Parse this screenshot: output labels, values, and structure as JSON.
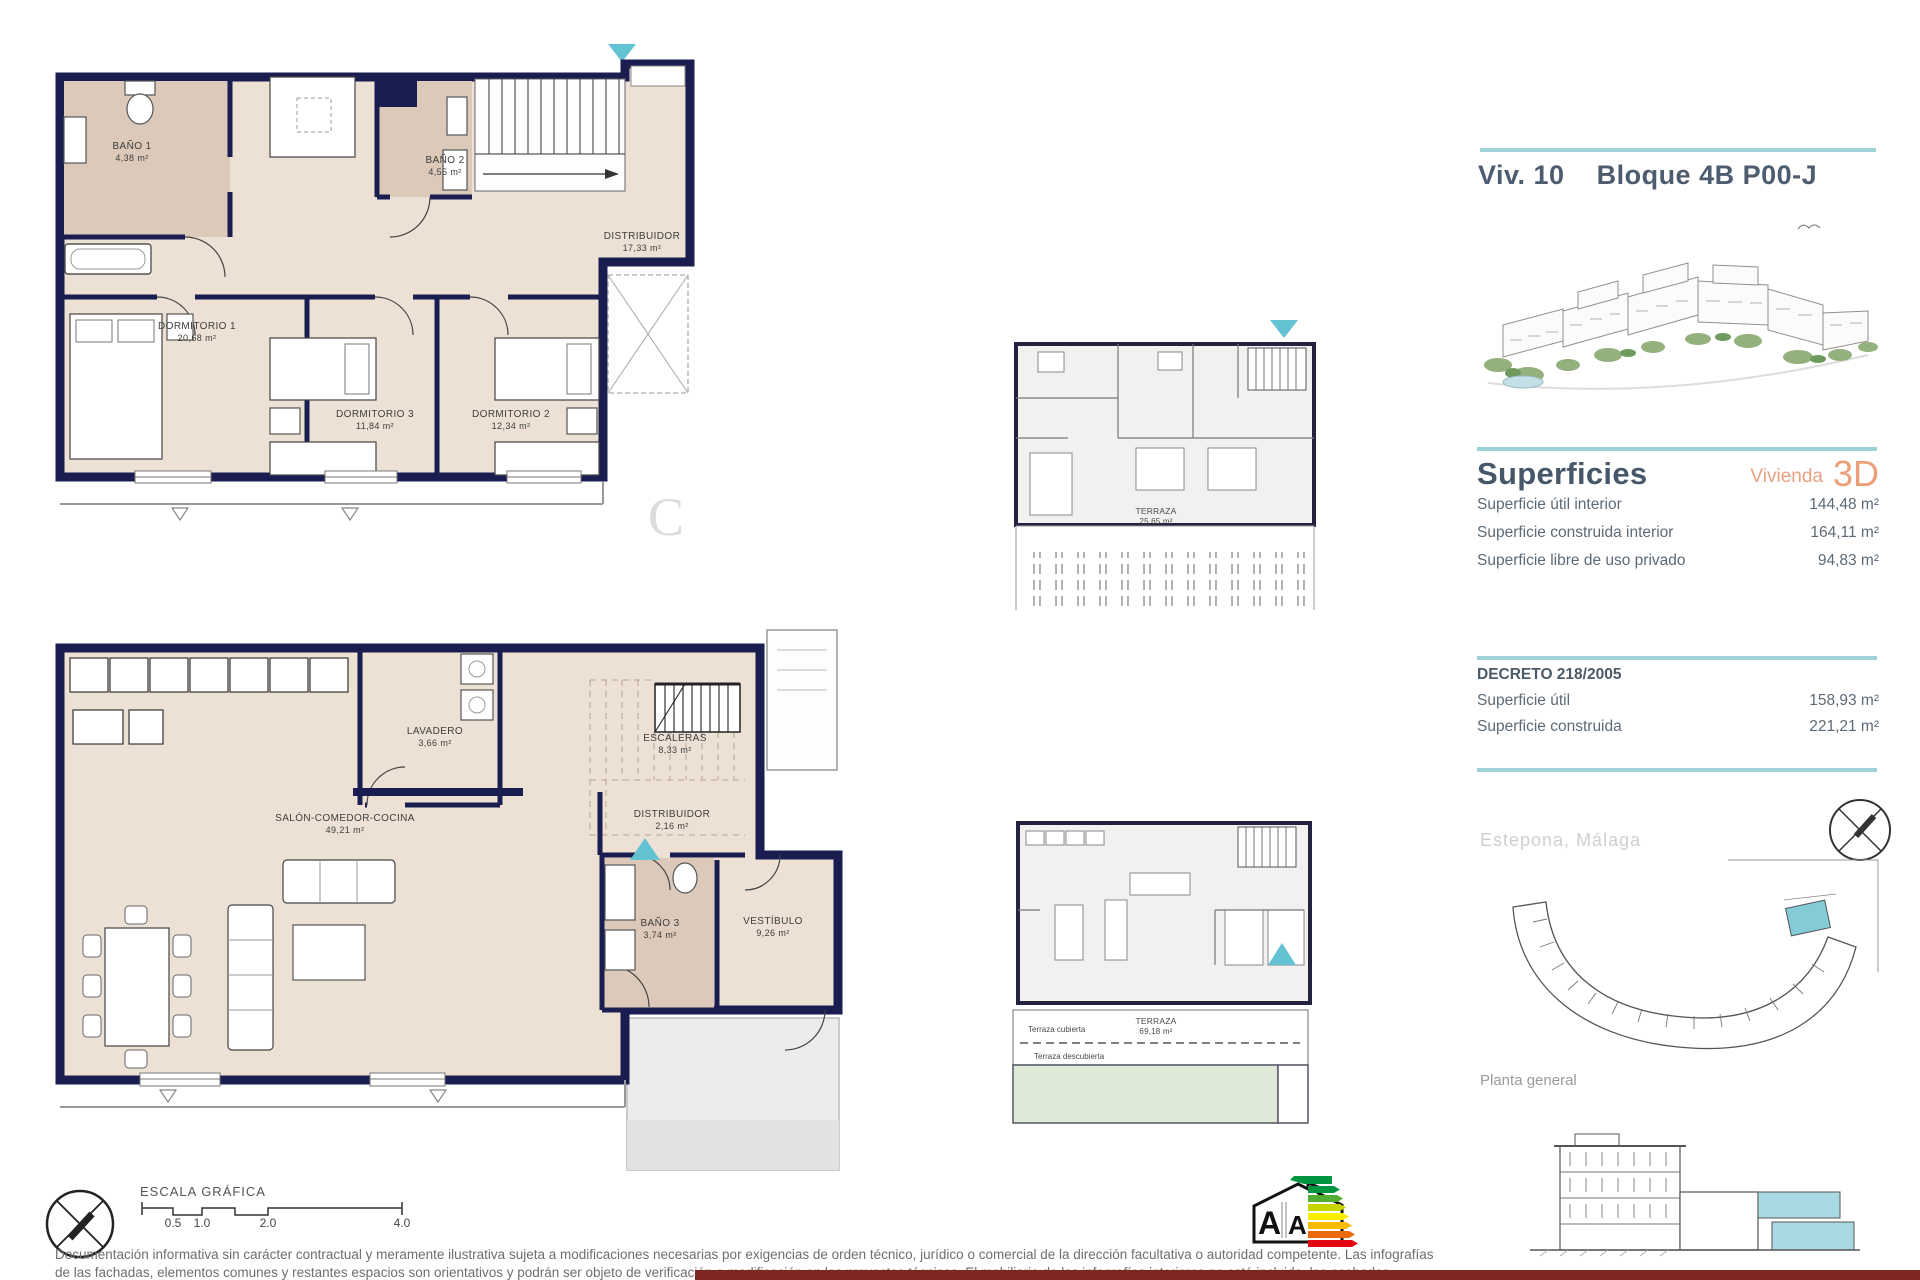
{
  "header": {
    "unit": "Viv. 10",
    "block": "Bloque 4B P00-J"
  },
  "watermark": "C",
  "upper_plan": {
    "rooms": [
      {
        "name": "BAÑO 1",
        "area": "4,38 m²"
      },
      {
        "name": "BAÑO 2",
        "area": "4,55 m²"
      },
      {
        "name": "DISTRIBUIDOR",
        "area": "17,33 m²"
      },
      {
        "name": "DORMITORIO 1",
        "area": "20,68 m²"
      },
      {
        "name": "DORMITORIO 3",
        "area": "11,84 m²"
      },
      {
        "name": "DORMITORIO 2",
        "area": "12,34 m²"
      }
    ]
  },
  "lower_plan": {
    "rooms": [
      {
        "name": "LAVADERO",
        "area": "3,66 m²"
      },
      {
        "name": "ESCALERAS",
        "area": "8,33 m²"
      },
      {
        "name": "SALÓN-COMEDOR-COCINA",
        "area": "49,21 m²"
      },
      {
        "name": "DISTRIBUIDOR",
        "area": "2,16 m²"
      },
      {
        "name": "BAÑO 3",
        "area": "3,74 m²"
      },
      {
        "name": "VESTÍBULO",
        "area": "9,26 m²"
      }
    ]
  },
  "thumb_upper": {
    "terrace": {
      "name": "TERRAZA",
      "area": "25,65 m²"
    }
  },
  "thumb_lower": {
    "terrace": {
      "name": "TERRAZA",
      "area": "69,18 m²"
    },
    "covered": "Terraza cubierta",
    "uncovered": "Terraza descubierta"
  },
  "superficies": {
    "title": "Superficies",
    "subtitle": "Vivienda",
    "badge": "3D",
    "rows": [
      {
        "label": "Superficie útil interior",
        "value": "144,48 m²"
      },
      {
        "label": "Superficie construida interior",
        "value": "164,11 m²"
      },
      {
        "label": "Superficie libre de uso privado",
        "value": "94,83 m²"
      }
    ]
  },
  "decreto": {
    "title": "DECRETO 218/2005",
    "rows": [
      {
        "label": "Superficie útil",
        "value": "158,93 m²"
      },
      {
        "label": "Superficie construida",
        "value": "221,21 m²"
      }
    ]
  },
  "location": {
    "city": "Estepona, Málaga",
    "plan_label": "Planta general"
  },
  "scale": {
    "title": "ESCALA GRÁFICA",
    "ticks": [
      "0.5",
      "1.0",
      "2.0",
      "4.0"
    ]
  },
  "energy": {
    "a_left": "A",
    "a_right": "A"
  },
  "footer": {
    "line1": "Documentación informativa sin carácter contractual y meramente ilustrativa sujeta a modificaciones necesarias por exigencias de orden técnico, jurídico o comercial de la dirección facultativa o autoridad competente. Las infografías",
    "line2": "de las fachadas, elementos comunes y restantes espacios son orientativos y podrán ser objeto de verificación o modificación en los proyectos técnicos. El mobiliario de las infografías interiores no está incluido, los acabados"
  },
  "colors": {
    "wall": "#191d4f",
    "floor": "#ece1d4",
    "wet_floor": "#dcc9b9",
    "teal_marker": "#63c3d3",
    "teal_line": "#9ed2d8",
    "accent_orange": "#e8a182",
    "maroon_bar": "#7d2720"
  }
}
